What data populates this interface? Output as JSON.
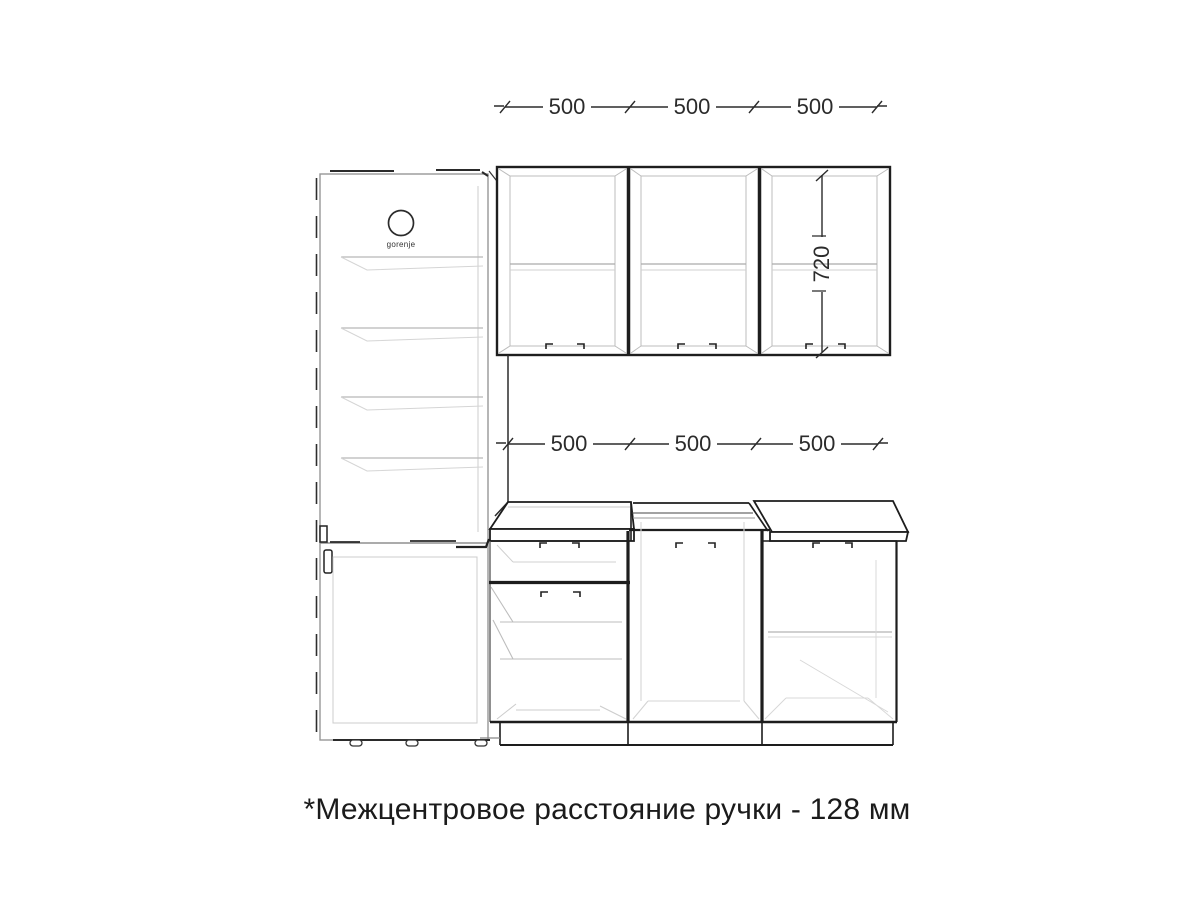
{
  "annotations": {
    "upper_dimensions": [
      "500",
      "500",
      "500"
    ],
    "base_dimensions": [
      "500",
      "500",
      "500"
    ],
    "upper_cabinet_height": "720",
    "note": "*Межцентровое расстояние ручки - 128 мм"
  },
  "fridge": {
    "brand": "gorenje"
  },
  "units": "mm",
  "colors": {
    "line_dark": "#1d1d1d",
    "line_medium": "#555555",
    "line_light": "#b4b4b4",
    "line_faint": "#d2d2d2",
    "dim_text": "#2b2b2b",
    "note_text": "#1b1b1b",
    "background": "#ffffff"
  }
}
